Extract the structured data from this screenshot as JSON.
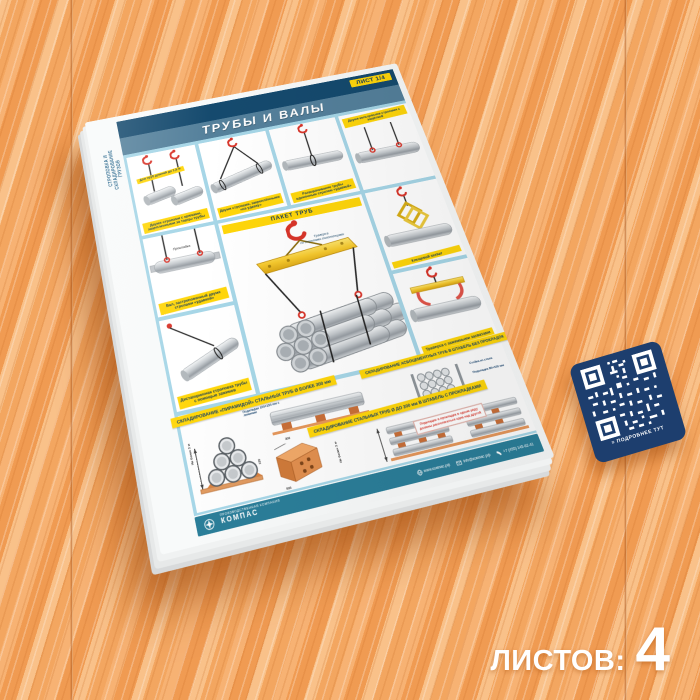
{
  "page": {
    "sheets_label": "ЛИСТОВ:",
    "sheets_value": "4"
  },
  "poster": {
    "side_label_line1": "СТРОПОВКА И",
    "side_label_line2": "СКЛАДИРОВАНИЕ",
    "side_label_line3": "ГРУЗОВ",
    "sheet_badge": "ЛИСТ 1/4",
    "title": "ТРУБЫ И ВАЛЫ",
    "panels": {
      "end_hooks": {
        "label": "Для труб длиной до 1,5 м",
        "caption": "Двумя стропами с крюками, зацепленными за торцы трубы"
      },
      "double_choker": {
        "caption": "Двумя стропами, закреплёнными «на удавку»"
      },
      "single_choker": {
        "caption": "Разворачивание трубы одиночным стропом «удавкой»"
      },
      "ring_sling": {
        "caption": "Двумя кольцевыми стропами с защёлкой"
      },
      "shaft": {
        "part_label": "Прокладка",
        "caption": "Вал, застропованный двумя стропами «удавкой»"
      },
      "remote": {
        "caption": "Дистанционная строповка трубы с помощью зажимов"
      },
      "tongs": {
        "caption": "Клещевой захват"
      },
      "clamp_traverse": {
        "caption": "Траверса с зажимными захватами"
      }
    },
    "package": {
      "title": "ПАКЕТ ТРУБ",
      "traverse_label_1": "Траверса",
      "traverse_label_2": "со стропами-полотенцами"
    },
    "storage": {
      "banner_pyramid": "СКЛАДИРОВАНИЕ «ПИРАМИДОЙ» СТАЛЬНЫХ ТРУБ Ø БОЛЕЕ 300 мм",
      "banner_asbestos": "СКЛАДИРОВАНИЕ АСБОЦЕМЕНТНЫХ ТРУБ В ШТАБЕЛЬ БЕЗ ПРОКЛАДОК",
      "banner_steel": "СКЛАДИРОВАНИЕ СТАЛЬНЫХ ТРУБ Ø ДО 300 мм В ШТАБЕЛЬ С ПРОКЛАДКАМИ",
      "dim_height_1": "Не более 3 м",
      "dim_height_2": "Не более 3 м",
      "pads_large": "Подкладки 100×150 мм с лежнями",
      "pads_small": "Подкладки 80×100 мм",
      "rack": "Стойка из стали",
      "warning": "Подкладки и прокладки в одном ряду должны располагаться одна над другой",
      "wedge_dims": {
        "a": "100",
        "b": "300",
        "c": "500"
      }
    },
    "qr_icon": "≡",
    "qr_caption": "ПОДРОБНЕЕ ТУТ",
    "footer": {
      "brand": "КОМПАС",
      "brand_tagline": "ПРОИЗВОДСТВЕННАЯ КОМПАНИЯ",
      "website": "www.компас.рф",
      "email": "info@компас.рф",
      "phone": "+7 (495) 145-62-41"
    }
  },
  "colors": {
    "wood_orange": "#f2a45f",
    "accent_yellow": "#ffd60a",
    "header_navy": "#154a6e",
    "title_band_blue": "#54809b",
    "gutter_blue": "#a6d6e7",
    "footer_teal": "#2b7e99",
    "alert_red": "#d9352a",
    "qr_navy": "#1d3e6e"
  }
}
